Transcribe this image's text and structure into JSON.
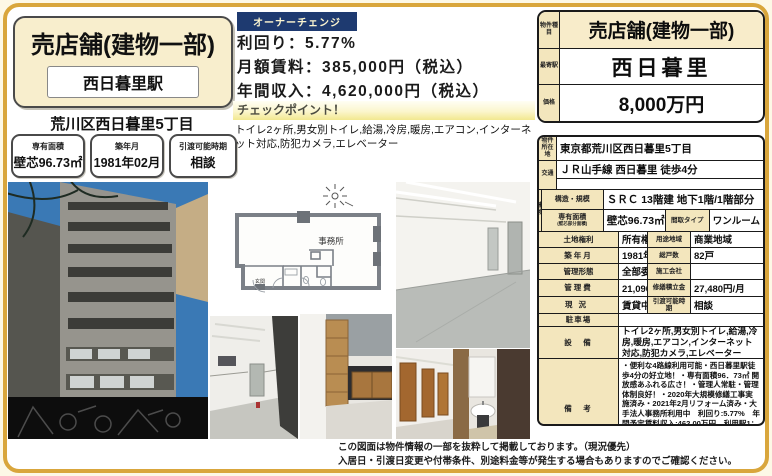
{
  "colors": {
    "frame_gold": "#d9a63c",
    "badge_navy": "#1e3a70",
    "label_tan": "#f3e6bd",
    "title_cream": "#f8eecd"
  },
  "flyer": {
    "title": "売店舗(建物一部)",
    "station_box": "西日暮里駅",
    "address": "荒川区西日暮里5丁目",
    "info_boxes": [
      {
        "label": "専有面積",
        "value": "壁芯96.73㎡"
      },
      {
        "label": "築年月",
        "value": "1981年02月"
      },
      {
        "label": "引渡可能時期",
        "value": "相談"
      }
    ],
    "badge": "オーナーチェンジ",
    "yield_line": "利回り：5.77%",
    "monthly_line": "月額賃料：385,000円（税込）",
    "annual_line": "年間収入：4,620,000円（税込）",
    "checkpoint_label": "チェックポイント！",
    "checkpoint_features": "トイレ2ヶ所,男女別トイレ,給湯,冷房,暖房,エアコン,インターネット対応,防犯カメラ,エレベーター",
    "floor_plan_room": "事務所",
    "floor_plan_entrance": "玄関",
    "footer_line1": "この図面は物件情報の一部を抜粋して掲載しております。（現況優先）",
    "footer_line2": "入居日・引渡日変更や付帯条件、別途料金等が発生する場合もありますのでご確認ください。"
  },
  "price_table": {
    "type_label": "物件種目",
    "type_value": "売店舗(建物一部)",
    "station_label": "最寄駅",
    "station_value": "西日暮里",
    "price_label": "価格",
    "price_value": "8,000万円"
  },
  "details": {
    "location_label": "物件所在地",
    "location": "東京都荒川区西日暮里5丁目",
    "access_label": "交通",
    "access": "ＪＲ山手線 西日暮里 徒歩4分",
    "access2": "",
    "building_label": "建物",
    "structure_label": "構造・規模",
    "structure": "ＳＲＣ 13階建 地下1階/1階部分",
    "area_label": "専有面積",
    "area_sublabel": "(壁芯部分面積)",
    "area": "壁芯96.73㎡",
    "layout_label": "間取タイプ",
    "layout": "ワンルーム",
    "land_label": "土地権利",
    "land": "所有権",
    "zoning_label": "用途地域",
    "zoning": "商業地域",
    "built_label": "築年月",
    "built": "1981年02月",
    "units_label": "総戸数",
    "units": "82戸",
    "mgmt_form_label": "管理形態",
    "mgmt_form": "全部委託",
    "constructor_label": "施工会社",
    "constructor": "",
    "mgmt_fee_label": "管理費",
    "mgmt_fee": "21,090円/月",
    "repair_label": "修繕積立金",
    "repair": "27,480円/月",
    "status_label": "現況",
    "status": "賃貸中",
    "handover_label": "引渡可能時期",
    "handover": "相談",
    "parking_label": "駐車場",
    "parking": "",
    "equipment_label": "設　備",
    "equipment": "トイレ2ヶ所,男女別トイレ,給湯,冷房,暖房,エアコン,インターネット対応,防犯カメラ,エレベーター",
    "remarks_label": "備　考",
    "remarks": "・便利な4路線利用可能・西日暮里駅徒歩4分の好立地！・専有面積96．73㎡ 開放感あふれる広さ！・管理人常駐・管理体制良好！・2020年大規模修繕工事実施済み・2021年2月リフォーム済み・大手法人事務所利用中　利回り:5.77%　年間予定賃料収入:462.00万円　利用駅1：ＪＲ京浜東北・根岸線 西日暮里 徒歩4分　利用駅2：東京メトロ千代田線 西日暮里 徒歩3分"
  }
}
